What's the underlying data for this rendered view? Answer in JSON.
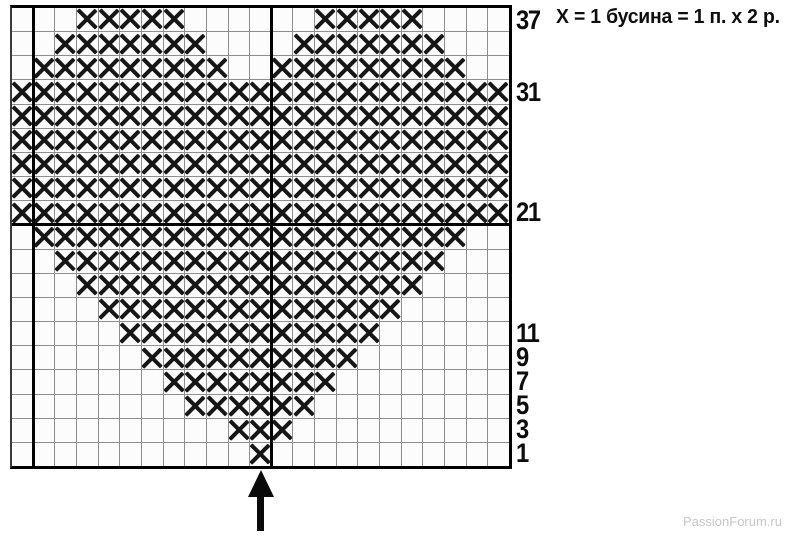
{
  "legend": {
    "symbol_note": "Х = 1 бусина = 1 п. х 2 р."
  },
  "watermark": {
    "text": "PassionForum.ru"
  },
  "chart_data": {
    "type": "heatmap",
    "description_visible": false,
    "grid": {
      "columns": 23,
      "rows": 19
    },
    "rows": [
      {
        "label": "37",
        "x_ranges": [
          [
            3,
            7
          ],
          [
            14,
            18
          ]
        ]
      },
      {
        "label": "",
        "x_ranges": [
          [
            2,
            8
          ],
          [
            13,
            19
          ]
        ]
      },
      {
        "label": "",
        "x_ranges": [
          [
            1,
            9
          ],
          [
            12,
            20
          ]
        ]
      },
      {
        "label": "31",
        "x_ranges": [
          [
            0,
            22
          ]
        ]
      },
      {
        "label": "",
        "x_ranges": [
          [
            0,
            22
          ]
        ]
      },
      {
        "label": "",
        "x_ranges": [
          [
            0,
            22
          ]
        ]
      },
      {
        "label": "",
        "x_ranges": [
          [
            0,
            22
          ]
        ]
      },
      {
        "label": "",
        "x_ranges": [
          [
            0,
            22
          ]
        ]
      },
      {
        "label": "21",
        "x_ranges": [
          [
            0,
            22
          ]
        ]
      },
      {
        "label": "",
        "x_ranges": [
          [
            1,
            20
          ]
        ]
      },
      {
        "label": "",
        "x_ranges": [
          [
            2,
            19
          ]
        ]
      },
      {
        "label": "",
        "x_ranges": [
          [
            3,
            18
          ]
        ]
      },
      {
        "label": "",
        "x_ranges": [
          [
            4,
            17
          ]
        ]
      },
      {
        "label": "11",
        "x_ranges": [
          [
            5,
            16
          ]
        ]
      },
      {
        "label": "9",
        "x_ranges": [
          [
            6,
            15
          ]
        ]
      },
      {
        "label": "7",
        "x_ranges": [
          [
            7,
            14
          ]
        ]
      },
      {
        "label": "5",
        "x_ranges": [
          [
            8,
            13
          ]
        ]
      },
      {
        "label": "3",
        "x_ranges": [
          [
            10,
            12
          ]
        ]
      },
      {
        "label": "1",
        "x_ranges": [
          [
            11,
            11
          ]
        ]
      }
    ],
    "bold_column_boundaries": [
      1,
      12
    ],
    "bold_row_boundaries": [
      9
    ],
    "arrow_column": 11,
    "mark_symbol": "X",
    "colors": {
      "mark": "#161616",
      "grid_line": "#8e8e8e",
      "bold_line": "#000000",
      "cell_bg": "#fcfcfc",
      "page_bg": "#ffffff"
    }
  }
}
